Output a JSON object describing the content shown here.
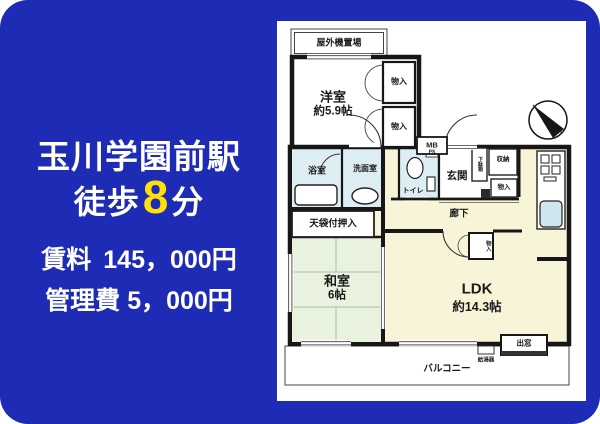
{
  "colors": {
    "card_blue": "#1e2bb4",
    "highlight_yellow": "#ffdf06",
    "plan_cream": "#f8f4d8",
    "tatami_green": "#e9f2df",
    "wet_area_blue": "#dcedf3",
    "sink_blue": "#cfe6ef",
    "wall_black": "#171717"
  },
  "promo": {
    "station": "玉川学園前駅",
    "walk_prefix": "徒歩",
    "walk_minutes": "8",
    "walk_suffix": "分",
    "rent_label": "賃料",
    "rent_value": "145，000円",
    "fee_label": "管理費",
    "fee_value": "5，000円"
  },
  "floorplan": {
    "outdoor_unit": "屋外機置場",
    "western_room_name": "洋室",
    "western_room_size": "約5.9帖",
    "closet_top_1": "物入",
    "closet_top_2": "物入",
    "meter_box": "MB",
    "pipe_space": "PS",
    "bathroom": "浴室",
    "washroom": "洗面室",
    "toilet": "トイレ",
    "entrance": "玄関",
    "shoe_cabinet": "下駄箱",
    "storage": "収納",
    "storage_small": "物入",
    "closet_japanese": "天袋付押入",
    "japanese_room_name": "和室",
    "japanese_room_size": "6帖",
    "hallway": "廊下",
    "ldk_name": "LDK",
    "ldk_size": "約14.3帖",
    "ldk_closet": "物入",
    "bay_window": "出窓",
    "water_heater": "給湯器",
    "balcony": "バルコニー"
  },
  "icons": {
    "compass": "north-arrow-compass-icon",
    "bathtub": "bathtub-icon",
    "sink": "wash-basin-icon",
    "toilet_bowl": "toilet-icon",
    "stove": "stove-burners-icon",
    "kitchen_sink": "kitchen-sink-icon"
  }
}
